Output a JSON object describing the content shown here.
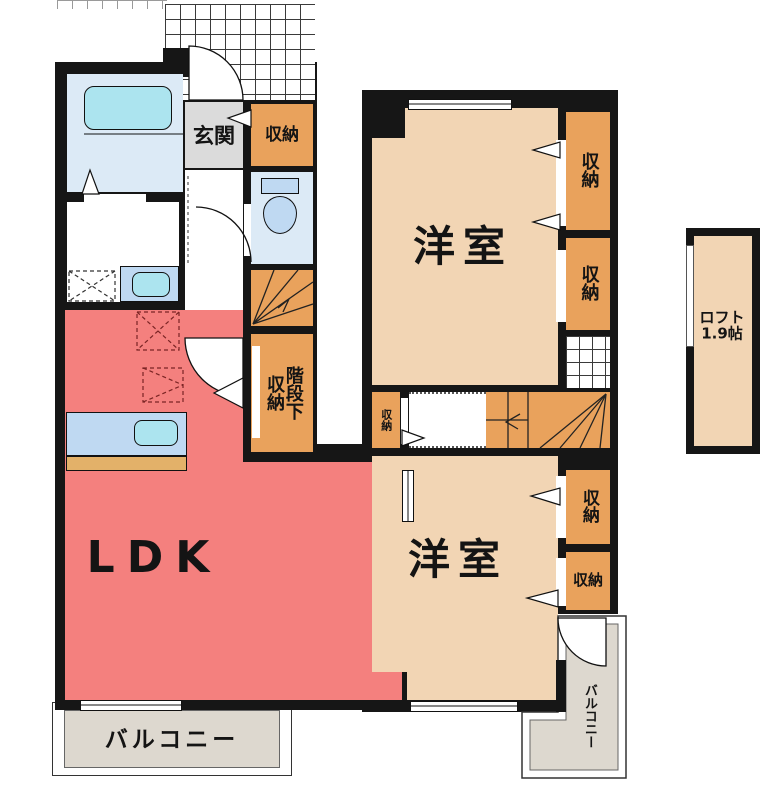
{
  "floorplan": {
    "floor1": {
      "ldk": "LDK",
      "entrance": "玄関",
      "storage": "収納",
      "under_stair_storage": [
        "階段下",
        "収納"
      ],
      "balcony": "バルコニー"
    },
    "floor2": {
      "bedroom_top": "洋室",
      "bedroom_bottom": "洋室",
      "storage": "収納",
      "balcony": "バルコニー",
      "loft": [
        "ロフト",
        "1.9帖"
      ]
    },
    "palette": {
      "wall": "#161616",
      "ldk": "#F4807E",
      "room": "#F2D5B4",
      "storage": "#E9A25C",
      "wet_room": "#DCEAF6",
      "fixture": "#BFD9F2",
      "tub": "#ACE4EF",
      "entrance_floor": "#DBDBDB",
      "balcony_floor": "#DDD8CF",
      "kitchen_counter": "#E3B169"
    }
  }
}
